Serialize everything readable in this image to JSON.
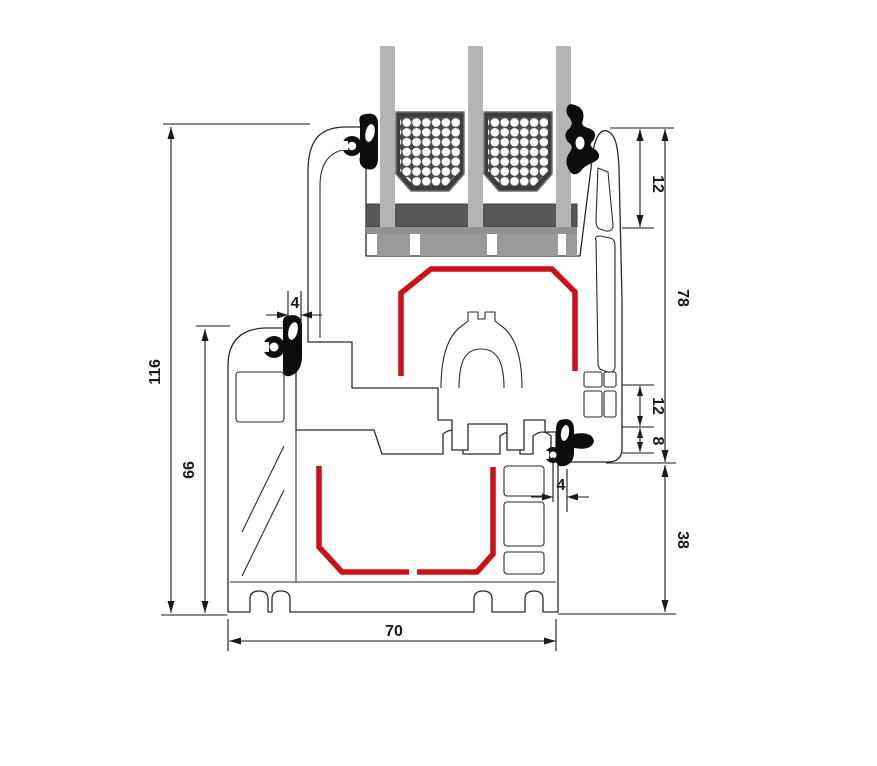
{
  "title": "Window profile cross-section technical drawing",
  "dimensions": {
    "overall_height": "116",
    "frame_height": "66",
    "top_gasket_width": "4",
    "glazing_inset_depth": "12",
    "sash_height": "78",
    "rebate_offset": "12",
    "seal_gap": "8",
    "lower_frame_height": "38",
    "bottom_gasket_width": "4",
    "profile_depth": "70"
  },
  "colors": {
    "steel_reinforcement": "#cc1016",
    "profile_outline": "#2a2a2a",
    "glass": "#b4b4b4",
    "spacer": "#3d3d3d",
    "gasket": "#0d0d0d",
    "background": "#ffffff"
  },
  "components": {
    "glazing": "triple-glazing-unit",
    "upper_profile": "sash-profile",
    "lower_profile": "frame-profile",
    "reinforcement": "steel-reinforcement",
    "seals": "rubber-gaskets"
  }
}
